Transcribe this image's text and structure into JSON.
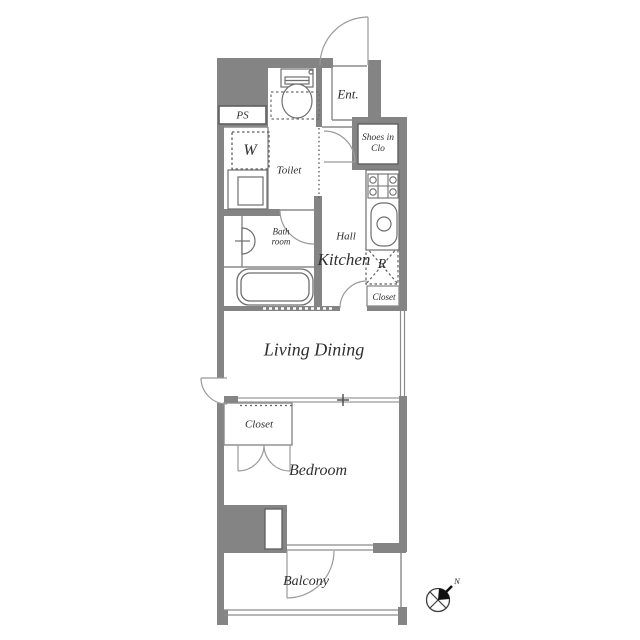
{
  "floorplan": {
    "labels": {
      "ps": "PS",
      "washer": "W",
      "toilet": "Toilet",
      "entrance": "Ent.",
      "shoes_closet": "Shoes in Clo",
      "bathroom": "Bath room",
      "hall": "Hall",
      "kitchen": "Kitchen",
      "refrigerator": "R",
      "kitchen_closet": "Closet",
      "living_dining": "Living Dining",
      "bedroom_closet": "Closet",
      "bedroom": "Bedroom",
      "balcony": "Balcony",
      "compass_north": "N"
    },
    "colors": {
      "wall": "#848484",
      "line": "#8a8a8a",
      "fixture_line": "#6e6e6e",
      "text": "#2f2f2f",
      "background": "#ffffff",
      "compass": "#111111"
    }
  }
}
